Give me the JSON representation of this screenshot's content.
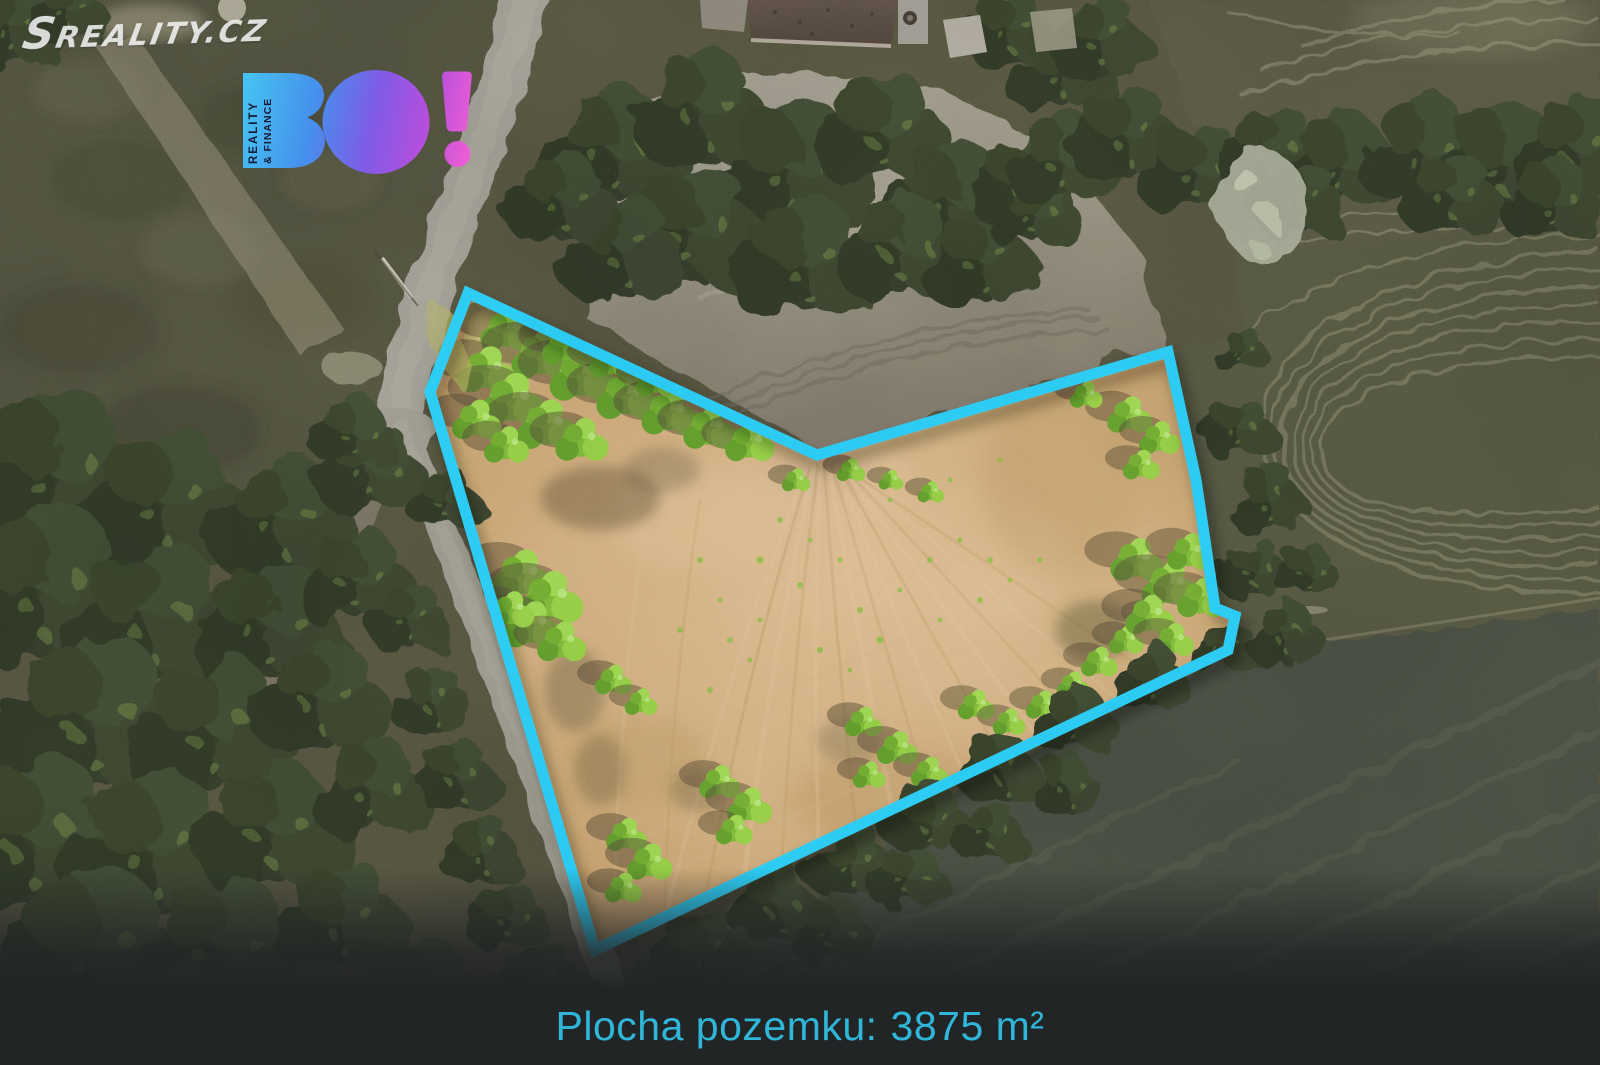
{
  "watermark": {
    "text": "Sreality.cz"
  },
  "logo": {
    "wordmark": "BO!",
    "vertical_line1": "REALITY",
    "vertical_line2": "& FINANCE"
  },
  "footer": {
    "label": "Plocha pozemku:",
    "value": "3875 m²"
  },
  "plot": {
    "area_m2": 3875,
    "outline_points": "468,293 817,455 1168,352 1196,480 1215,608 1235,616 1228,650 595,950 430,392"
  },
  "colors": {
    "outline": "#27c3f3",
    "footer_text": "#2fb6d8",
    "footer_bg": "#222526",
    "logo_plate_text": "#171a33",
    "logo_gradient": [
      "#46c1f1",
      "#4590ec",
      "#7e5ce6",
      "#b44fdd",
      "#f25fd3"
    ]
  }
}
